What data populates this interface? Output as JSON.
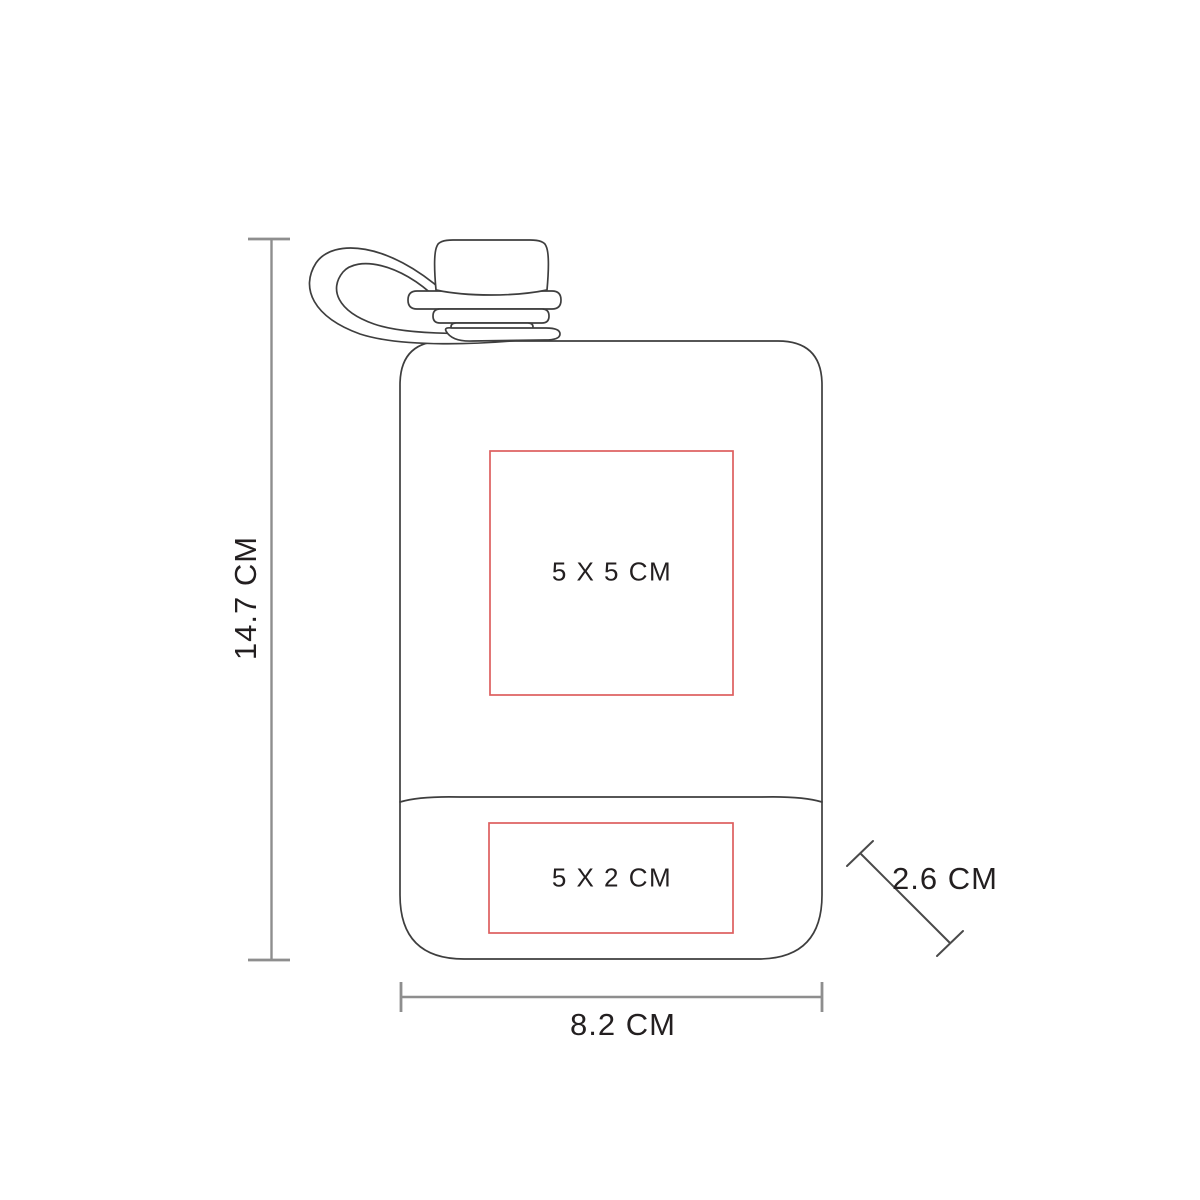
{
  "diagram": {
    "type": "product-dimension-diagram",
    "subject": "flask-bottle-line-drawing",
    "labels": {
      "height": "14.7 CM",
      "width": "8.2 CM",
      "depth": "2.6 CM",
      "print_area_front": "5 X 5 CM",
      "print_area_bottom": "5 X 2 CM"
    },
    "colors": {
      "outline": "#3e3e3e",
      "dimension_line": "#8e8e8e",
      "dimension_tick": "#757575",
      "dimension_diagonal": "#4a4a4a",
      "print_area": "#dd5f5f",
      "text": "#231f20",
      "background": "#ffffff"
    }
  }
}
